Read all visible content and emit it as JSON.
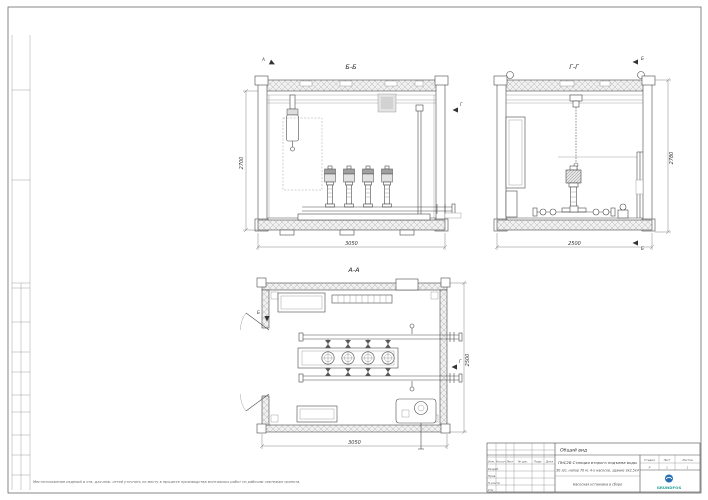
{
  "sheet": {
    "footnote": "Местоположение изделий и отв. для инж. сетей уточнять по месту в процессе производства монтажных работ по рабочим чертежам проекта."
  },
  "views": {
    "front": {
      "label": "Б-Б",
      "dim_left": "2700",
      "dim_bottom": "3050",
      "cut_top": "А",
      "cut_right": "Г"
    },
    "side": {
      "label": "Г-Г",
      "dim_right": "2780",
      "dim_bottom": "2500",
      "cut_top": "Б",
      "cut_bottom": "Б"
    },
    "plan": {
      "label": "А-А",
      "dim_right": "2500",
      "dim_bottom": "3050",
      "cut_top": "Б",
      "cut_right": "Г"
    }
  },
  "title_block": {
    "doc_type": "Общий вид",
    "project_line1": "ПНС2В Станция второго подъема воды",
    "project_line2": "50 л/с, напор 70 м, 4-х насосов, здание 3х2,5х4",
    "sheet_name": "Насосная установка в сборе",
    "rev_cols": [
      "Изм.",
      "Кол.уч",
      "Лист",
      "№ док.",
      "Подп.",
      "Дата"
    ],
    "rev_rows": [
      "Разраб.",
      "Пров.",
      "Н.контр.",
      "Утв."
    ],
    "stage_label": "Стадия",
    "sheet_label": "Лист",
    "sheets_label": "Листов",
    "stage_value": "Р",
    "sheet_value": "1",
    "sheets_value": "1",
    "logo_text": "GRUNDFOS",
    "logo_color": "#2b6fb5"
  }
}
